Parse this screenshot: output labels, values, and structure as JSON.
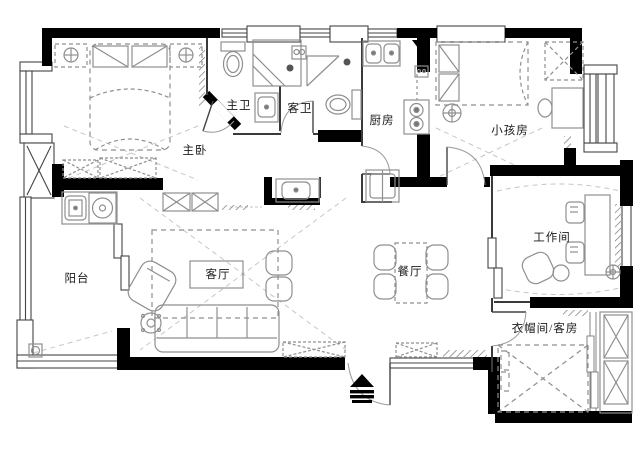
{
  "page": {
    "type": "residential-floor-plan",
    "language": "zh-CN"
  },
  "rooms": [
    {
      "id": "master-bedroom",
      "label": "主卧"
    },
    {
      "id": "master-bathroom",
      "label": "主卫"
    },
    {
      "id": "guest-bathroom",
      "label": "客卫"
    },
    {
      "id": "kitchen",
      "label": "厨房"
    },
    {
      "id": "kids-room",
      "label": "小孩房"
    },
    {
      "id": "workroom",
      "label": "工作间"
    },
    {
      "id": "dining-room",
      "label": "餐厅"
    },
    {
      "id": "living-room",
      "label": "客厅"
    },
    {
      "id": "balcony",
      "label": "阳台"
    },
    {
      "id": "cloakroom-guestroom",
      "label": "衣帽间/客房"
    }
  ],
  "symbols": {
    "entrance-arrow": "solid triangle with stacked bars (entry direction)",
    "wardrobe-box": "rectangle with X",
    "ceiling-lamp": "circle with cross"
  },
  "colors": {
    "wall": "#000000",
    "thin-wall": "#3a3a3a",
    "fixture-line": "#8f8f8f",
    "dashed-detail": "#c0c0c0",
    "label-text": "#1a1a1a",
    "background": "#ffffff"
  }
}
